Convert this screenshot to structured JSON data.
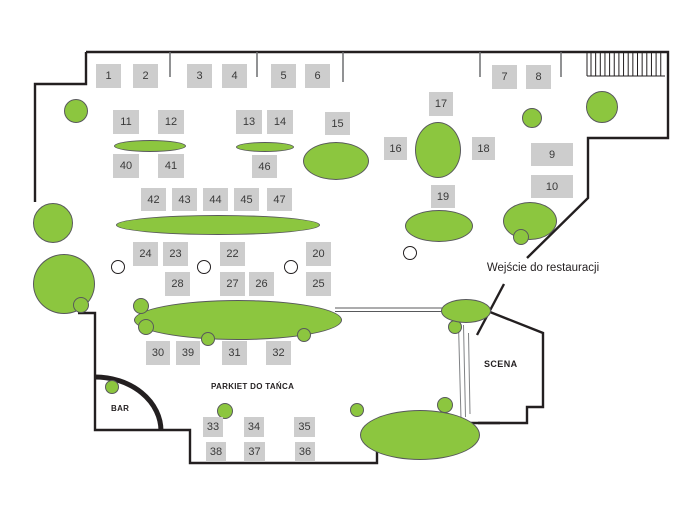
{
  "labels": {
    "entrance": "Wejście do restauracji",
    "stage": "SCENA",
    "bar": "BAR",
    "dance_floor": "PARKIET DO TAŃCA"
  },
  "colors": {
    "table_green": "#8cc63f",
    "green_stroke": "#58595b",
    "square_fill": "#cdcdcd",
    "square_text": "#3a3a3a",
    "wall": "#231f20",
    "tick": "#6d6e71"
  },
  "tables": [
    {
      "n": "1",
      "x": 96,
      "y": 64,
      "w": 25,
      "h": 24
    },
    {
      "n": "2",
      "x": 133,
      "y": 64,
      "w": 25,
      "h": 24
    },
    {
      "n": "3",
      "x": 187,
      "y": 64,
      "w": 25,
      "h": 24
    },
    {
      "n": "4",
      "x": 222,
      "y": 64,
      "w": 25,
      "h": 24
    },
    {
      "n": "5",
      "x": 271,
      "y": 64,
      "w": 25,
      "h": 24
    },
    {
      "n": "6",
      "x": 305,
      "y": 64,
      "w": 25,
      "h": 24
    },
    {
      "n": "7",
      "x": 492,
      "y": 65,
      "w": 25,
      "h": 24
    },
    {
      "n": "8",
      "x": 526,
      "y": 65,
      "w": 25,
      "h": 24
    },
    {
      "n": "17",
      "x": 429,
      "y": 92,
      "w": 24,
      "h": 24
    },
    {
      "n": "11",
      "x": 113,
      "y": 110,
      "w": 26,
      "h": 24
    },
    {
      "n": "12",
      "x": 158,
      "y": 110,
      "w": 26,
      "h": 24
    },
    {
      "n": "13",
      "x": 236,
      "y": 110,
      "w": 26,
      "h": 24
    },
    {
      "n": "14",
      "x": 267,
      "y": 110,
      "w": 26,
      "h": 24
    },
    {
      "n": "15",
      "x": 325,
      "y": 112,
      "w": 25,
      "h": 23
    },
    {
      "n": "16",
      "x": 384,
      "y": 137,
      "w": 23,
      "h": 23
    },
    {
      "n": "18",
      "x": 472,
      "y": 137,
      "w": 23,
      "h": 23
    },
    {
      "n": "9",
      "x": 531,
      "y": 143,
      "w": 42,
      "h": 23
    },
    {
      "n": "10",
      "x": 531,
      "y": 175,
      "w": 42,
      "h": 23
    },
    {
      "n": "40",
      "x": 113,
      "y": 154,
      "w": 26,
      "h": 24
    },
    {
      "n": "41",
      "x": 158,
      "y": 154,
      "w": 26,
      "h": 24
    },
    {
      "n": "46",
      "x": 252,
      "y": 155,
      "w": 25,
      "h": 23
    },
    {
      "n": "42",
      "x": 141,
      "y": 188,
      "w": 25,
      "h": 23
    },
    {
      "n": "43",
      "x": 172,
      "y": 188,
      "w": 25,
      "h": 23
    },
    {
      "n": "44",
      "x": 203,
      "y": 188,
      "w": 25,
      "h": 23
    },
    {
      "n": "45",
      "x": 234,
      "y": 188,
      "w": 25,
      "h": 23
    },
    {
      "n": "47",
      "x": 267,
      "y": 188,
      "w": 25,
      "h": 23
    },
    {
      "n": "19",
      "x": 431,
      "y": 185,
      "w": 24,
      "h": 23
    },
    {
      "n": "24",
      "x": 133,
      "y": 242,
      "w": 25,
      "h": 24
    },
    {
      "n": "23",
      "x": 163,
      "y": 242,
      "w": 25,
      "h": 24
    },
    {
      "n": "22",
      "x": 220,
      "y": 242,
      "w": 25,
      "h": 24
    },
    {
      "n": "20",
      "x": 306,
      "y": 242,
      "w": 25,
      "h": 24
    },
    {
      "n": "28",
      "x": 165,
      "y": 272,
      "w": 25,
      "h": 24
    },
    {
      "n": "27",
      "x": 220,
      "y": 272,
      "w": 25,
      "h": 24
    },
    {
      "n": "26",
      "x": 249,
      "y": 272,
      "w": 25,
      "h": 24
    },
    {
      "n": "25",
      "x": 306,
      "y": 272,
      "w": 25,
      "h": 24
    },
    {
      "n": "30",
      "x": 146,
      "y": 341,
      "w": 24,
      "h": 24
    },
    {
      "n": "39",
      "x": 176,
      "y": 341,
      "w": 24,
      "h": 24
    },
    {
      "n": "31",
      "x": 222,
      "y": 341,
      "w": 25,
      "h": 24
    },
    {
      "n": "32",
      "x": 266,
      "y": 341,
      "w": 25,
      "h": 24
    },
    {
      "n": "33",
      "x": 203,
      "y": 417,
      "w": 20,
      "h": 20
    },
    {
      "n": "34",
      "x": 244,
      "y": 417,
      "w": 20,
      "h": 20
    },
    {
      "n": "35",
      "x": 294,
      "y": 417,
      "w": 21,
      "h": 20
    },
    {
      "n": "38",
      "x": 206,
      "y": 442,
      "w": 20,
      "h": 20
    },
    {
      "n": "37",
      "x": 244,
      "y": 442,
      "w": 21,
      "h": 20
    },
    {
      "n": "36",
      "x": 295,
      "y": 442,
      "w": 20,
      "h": 20
    }
  ],
  "green_shapes": [
    {
      "name": "round-table",
      "cx": 53,
      "cy": 223,
      "rx": 20,
      "ry": 20
    },
    {
      "name": "round-table",
      "cx": 64,
      "cy": 284,
      "rx": 31,
      "ry": 30
    },
    {
      "name": "chair-circle",
      "cx": 81,
      "cy": 305,
      "rx": 8,
      "ry": 8
    },
    {
      "name": "round-table",
      "cx": 76,
      "cy": 111,
      "rx": 12,
      "ry": 12
    },
    {
      "name": "oval-table",
      "cx": 150,
      "cy": 146,
      "rx": 36,
      "ry": 6
    },
    {
      "name": "oval-table",
      "cx": 265,
      "cy": 147,
      "rx": 29,
      "ry": 5
    },
    {
      "name": "oval-table",
      "cx": 336,
      "cy": 161,
      "rx": 33,
      "ry": 19
    },
    {
      "name": "oval-table",
      "cx": 438,
      "cy": 150,
      "rx": 23,
      "ry": 28
    },
    {
      "name": "round-table",
      "cx": 532,
      "cy": 118,
      "rx": 10,
      "ry": 10
    },
    {
      "name": "round-table",
      "cx": 602,
      "cy": 107,
      "rx": 16,
      "ry": 16
    },
    {
      "name": "banquet-table",
      "cx": 218,
      "cy": 225,
      "rx": 102,
      "ry": 10
    },
    {
      "name": "oval-table",
      "cx": 439,
      "cy": 226,
      "rx": 34,
      "ry": 16
    },
    {
      "name": "oval-table",
      "cx": 530,
      "cy": 221,
      "rx": 27,
      "ry": 19
    },
    {
      "name": "chair-circle",
      "cx": 521,
      "cy": 237,
      "rx": 8,
      "ry": 8
    },
    {
      "name": "banquet-table",
      "cx": 238,
      "cy": 320,
      "rx": 104,
      "ry": 20
    },
    {
      "name": "chair-circle",
      "cx": 141,
      "cy": 306,
      "rx": 8,
      "ry": 8
    },
    {
      "name": "chair-circle",
      "cx": 146,
      "cy": 327,
      "rx": 8,
      "ry": 8
    },
    {
      "name": "chair-circle",
      "cx": 208,
      "cy": 339,
      "rx": 7,
      "ry": 7
    },
    {
      "name": "chair-circle",
      "cx": 304,
      "cy": 335,
      "rx": 7,
      "ry": 7
    },
    {
      "name": "chair-circle",
      "cx": 455,
      "cy": 327,
      "rx": 7,
      "ry": 7
    },
    {
      "name": "host-table",
      "cx": 466,
      "cy": 311,
      "rx": 25,
      "ry": 12
    },
    {
      "name": "chair-circle",
      "cx": 445,
      "cy": 405,
      "rx": 8,
      "ry": 8
    },
    {
      "name": "chair-circle",
      "cx": 357,
      "cy": 410,
      "rx": 7,
      "ry": 7
    },
    {
      "name": "oval-table",
      "cx": 420,
      "cy": 435,
      "rx": 60,
      "ry": 25
    },
    {
      "name": "chair-circle",
      "cx": 112,
      "cy": 387,
      "rx": 7,
      "ry": 7
    },
    {
      "name": "chair-circle",
      "cx": 225,
      "cy": 411,
      "rx": 8,
      "ry": 8
    }
  ],
  "white_circles": [
    {
      "cx": 118,
      "cy": 267,
      "r": 7
    },
    {
      "cx": 204,
      "cy": 267,
      "r": 7
    },
    {
      "cx": 291,
      "cy": 267,
      "r": 7
    },
    {
      "cx": 410,
      "cy": 253,
      "r": 7
    }
  ]
}
